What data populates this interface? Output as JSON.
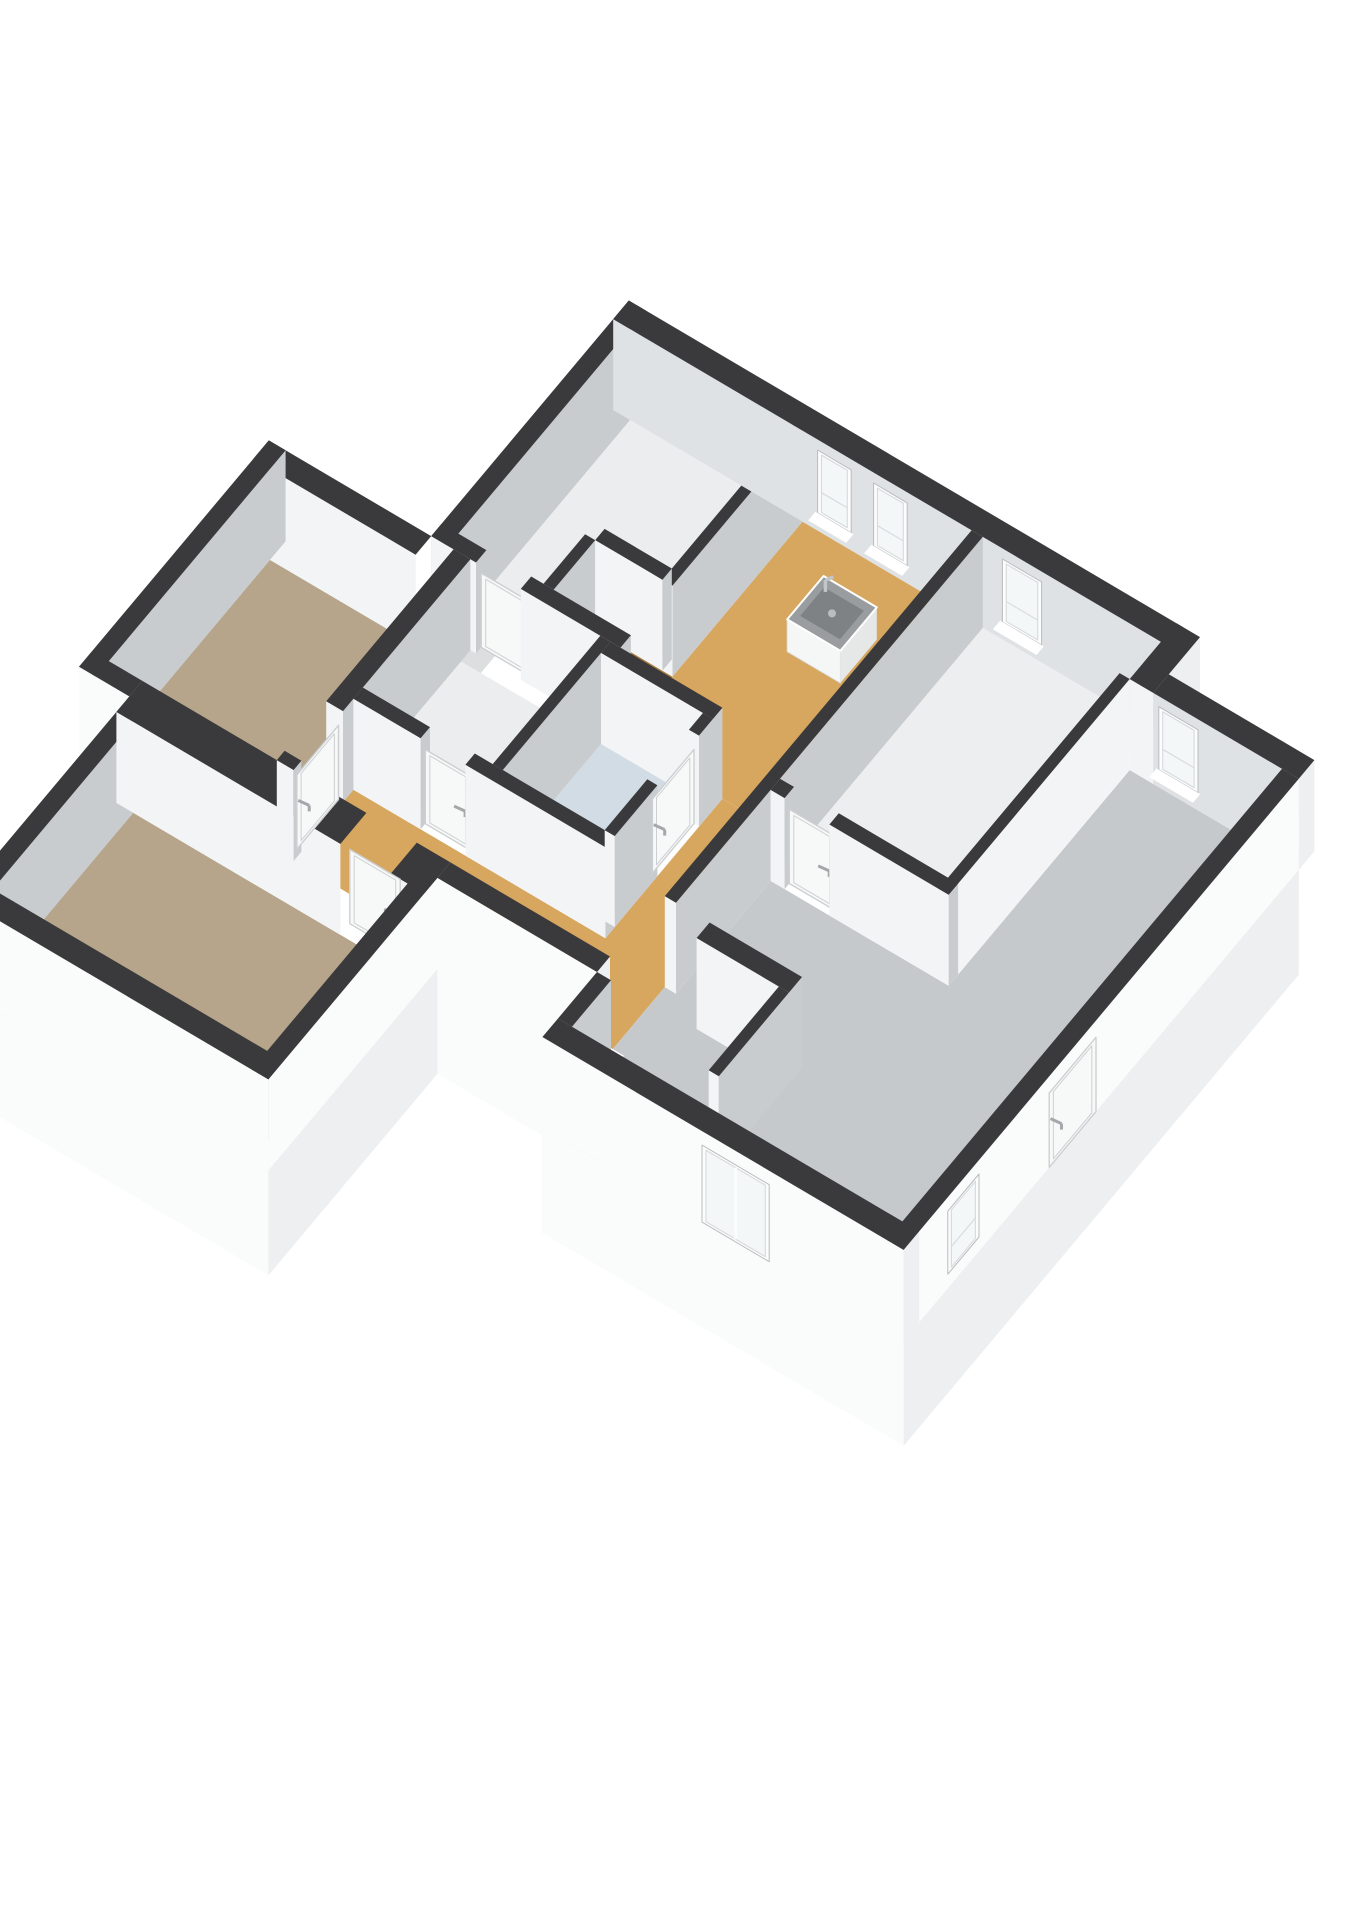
{
  "meta": {
    "background": "#ffffff",
    "view": "isometric-3d-floorplan"
  },
  "palette": {
    "wallTop": "#3a3a3c",
    "intBright": "#f3f4f5",
    "intShade": "#c9ccce",
    "neInt": "#dfe2e4",
    "extWhite": "#fafbfb",
    "extE": "#edeff0",
    "extGray": "#dcdee0",
    "glass": "#f4f7f8",
    "frame": "#fbfcfc",
    "mull": "#d9dcde",
    "reveal": "#b9bcbf",
    "leaf": "#f7f8f8",
    "leafLine": "#cdd0d2",
    "handle": "#a4a8ab",
    "sinkTop": "#999da0",
    "sinkTopDark": "#7e8285",
    "sinkBody": "#f5f6f6",
    "sinkSide": "#e6e8e8",
    "floorStudy": "#ebedee",
    "floorWood": "#a87c3f",
    "floorKitchen": "#d7a75f",
    "floorWhite": "#eceef0",
    "floorBath": "#d2dce4",
    "floorLiving": "#c6c9cb",
    "floorBedroom": "#b6a58b"
  },
  "floorplan": {
    "wall_height": 2.6,
    "skirt_depth": 3.0,
    "rooms": [
      {
        "id": "study",
        "floor": "floorStudy",
        "poly": [
          [
            0,
            0
          ],
          [
            2.9,
            0
          ],
          [
            2.9,
            2.32
          ],
          [
            1.52,
            2.32
          ],
          [
            1.52,
            3.3
          ],
          [
            0,
            3.3
          ]
        ]
      },
      {
        "id": "closet",
        "floor": "floorWood",
        "poly": [
          [
            1.7,
            2.5
          ],
          [
            3.08,
            2.5
          ],
          [
            3.08,
            3.3
          ],
          [
            1.7,
            3.3
          ]
        ]
      },
      {
        "id": "kitchen",
        "floor": "floorKitchen",
        "poly": [
          [
            3.08,
            0
          ],
          [
            6.1,
            0
          ],
          [
            6.1,
            3.5
          ],
          [
            3.08,
            3.5
          ]
        ]
      },
      {
        "id": "bedroom-3",
        "floor": "floorStudy",
        "poly": [
          [
            0.4,
            3.68
          ],
          [
            2.72,
            3.68
          ],
          [
            2.72,
            5.57
          ],
          [
            0.4,
            5.57
          ]
        ]
      },
      {
        "id": "bathroom",
        "floor": "floorBath",
        "poly": [
          [
            2.9,
            3.68
          ],
          [
            4.72,
            3.68
          ],
          [
            4.72,
            5.57
          ],
          [
            2.9,
            5.57
          ]
        ]
      },
      {
        "id": "hall",
        "floor": "floorKitchen",
        "poly": [
          [
            4.9,
            3.5
          ],
          [
            6.1,
            3.5
          ],
          [
            6.1,
            6.9
          ],
          [
            0.4,
            6.9
          ],
          [
            0.4,
            5.75
          ],
          [
            4.9,
            5.75
          ]
        ]
      },
      {
        "id": "bedroom-2",
        "floor": "floorWhite",
        "poly": [
          [
            6.3,
            0
          ],
          [
            9.3,
            0
          ],
          [
            9.3,
            3.9
          ],
          [
            6.3,
            3.9
          ]
        ]
      },
      {
        "id": "living-room",
        "floor": "floorLiving",
        "poly": [
          [
            9.48,
            0.6
          ],
          [
            12.2,
            0.6
          ],
          [
            12.2,
            7.9
          ],
          [
            6.3,
            7.9
          ],
          [
            6.3,
            6.9
          ],
          [
            6.1,
            6.9
          ],
          [
            6.1,
            5.9
          ],
          [
            6.3,
            5.9
          ],
          [
            6.3,
            4.08
          ],
          [
            9.48,
            4.08
          ]
        ]
      },
      {
        "id": "bedroom-west",
        "floor": "floorBedroom",
        "poly": [
          [
            -2.9,
            3.8
          ],
          [
            0.1,
            3.8
          ],
          [
            0.1,
            6.9
          ],
          [
            -2.9,
            6.9
          ]
        ]
      },
      {
        "id": "bedroom-south",
        "floor": "floorBedroom",
        "poly": [
          [
            -2.0,
            7.4
          ],
          [
            2.9,
            7.4
          ],
          [
            2.9,
            10.1
          ],
          [
            -2.0,
            10.1
          ]
        ]
      }
    ],
    "skirt": [
      {
        "id": "skirt-top-west",
        "from": [
          -0.3,
          -0.3
        ],
        "to": [
          -0.3,
          3.5
        ],
        "color": "extGray"
      },
      {
        "id": "skirt-wing-west",
        "from": [
          -3.2,
          3.5
        ],
        "to": [
          -3.2,
          7.15
        ],
        "color": "extGray"
      },
      {
        "id": "skirt-wing-south",
        "from": [
          -3.2,
          7.15
        ],
        "to": [
          -2.3,
          7.15
        ],
        "color": "extWhite"
      },
      {
        "id": "skirt-swbed-west",
        "from": [
          -2.3,
          7.15
        ],
        "to": [
          -2.3,
          10.4
        ],
        "color": "extGray"
      },
      {
        "id": "skirt-swbed-south",
        "from": [
          -2.3,
          10.4
        ],
        "to": [
          3.2,
          10.4
        ],
        "color": "extWhite"
      },
      {
        "id": "skirt-swbed-east",
        "from": [
          3.2,
          7.15
        ],
        "to": [
          3.2,
          10.4
        ],
        "color": "extE"
      },
      {
        "id": "skirt-hall-south",
        "from": [
          3.2,
          7.15
        ],
        "to": [
          6.05,
          7.15
        ],
        "color": "extWhite"
      },
      {
        "id": "skirt-living-west",
        "from": [
          6.05,
          7.15
        ],
        "to": [
          6.05,
          8.2
        ],
        "color": "extGray"
      },
      {
        "id": "skirt-living-south",
        "from": [
          6.05,
          8.2
        ],
        "to": [
          12.5,
          8.2
        ],
        "color": "extWhite"
      },
      {
        "id": "skirt-living-east",
        "from": [
          12.5,
          0.6
        ],
        "to": [
          12.5,
          8.2
        ],
        "color": "extE"
      }
    ],
    "walls": [
      {
        "id": "ext-ne-top",
        "rect": [
          -0.3,
          -0.3,
          9.6,
          0
        ],
        "faces": {
          "S": "neInt",
          "E": "extE"
        }
      },
      {
        "id": "ext-ne-jog",
        "rect": [
          9.48,
          -0.3,
          9.9,
          0.6
        ],
        "faces": {
          "S": "intBright",
          "E": "extE"
        }
      },
      {
        "id": "ext-ne-living",
        "rect": [
          9.9,
          0.3,
          12.5,
          0.6
        ],
        "faces": {
          "S": "neInt",
          "E": "extE"
        }
      },
      {
        "id": "ext-east",
        "rect": [
          12.2,
          0.6,
          12.5,
          8.2
        ],
        "faces": {
          "E": "extWhite"
        }
      },
      {
        "id": "ext-south",
        "rect": [
          6.05,
          7.9,
          12.5,
          8.2
        ],
        "faces": {
          "S": "extWhite",
          "E": "extE"
        }
      },
      {
        "id": "ext-living-w",
        "rect": [
          6.05,
          7.15,
          6.3,
          7.9
        ],
        "faces": {
          "E": "intShade",
          "W": "extGray"
        }
      },
      {
        "id": "ext-hall-s",
        "rect": [
          3.2,
          6.9,
          6.05,
          7.15
        ],
        "faces": {
          "S": "extWhite",
          "E": "extE"
        }
      },
      {
        "id": "ext-west-top",
        "rect": [
          -0.3,
          -0.3,
          0,
          3.5
        ],
        "faces": {
          "E": "intShade",
          "W": "extGray"
        }
      },
      {
        "id": "ext-wing-n",
        "rect": [
          -3.2,
          3.5,
          -0.3,
          3.8
        ],
        "faces": {
          "S": "intBright",
          "W": "extGray"
        }
      },
      {
        "id": "ext-wing-w",
        "rect": [
          -3.2,
          3.5,
          -2.9,
          7.15
        ],
        "faces": {
          "E": "intShade",
          "W": "extGray"
        }
      },
      {
        "id": "ext-wing-s",
        "rect": [
          -3.2,
          6.9,
          -2.3,
          7.15
        ],
        "faces": {
          "S": "extWhite",
          "W": "extGray"
        }
      },
      {
        "id": "ext-swbed-w",
        "rect": [
          -2.3,
          7.15,
          -2.0,
          10.4
        ],
        "faces": {
          "E": "intShade",
          "W": "extGray"
        }
      },
      {
        "id": "ext-swbed-s",
        "rect": [
          -2.3,
          10.1,
          3.2,
          10.4
        ],
        "faces": {
          "S": "extWhite",
          "E": "extE"
        }
      },
      {
        "id": "ext-swbed-e",
        "rect": [
          2.9,
          7.15,
          3.2,
          10.4
        ],
        "faces": {
          "E": "extWhite"
        }
      },
      {
        "id": "wall-swbed-n1",
        "rect": [
          -2.3,
          6.9,
          1.7,
          7.4
        ],
        "faces": {
          "S": "intBright"
        }
      },
      {
        "id": "wall-swbed-n2",
        "rect": [
          2.6,
          6.9,
          3.2,
          7.4
        ],
        "faces": {
          "S": "intBright",
          "E": "extWhite"
        }
      },
      {
        "id": "wall-study-kitchen",
        "rect": [
          2.9,
          0,
          3.08,
          2.5
        ],
        "faces": {
          "S": "intBright",
          "E": "intShade"
        }
      },
      {
        "id": "wall-closet-n",
        "rect": [
          1.7,
          2.32,
          2.9,
          2.5
        ],
        "faces": {
          "S": "intBright",
          "E": "intShade"
        }
      },
      {
        "id": "wall-closet-w",
        "rect": [
          1.52,
          2.5,
          1.7,
          3.3
        ],
        "faces": {
          "S": "intBright",
          "E": "intShade"
        }
      },
      {
        "id": "wall-study-b3-a",
        "rect": [
          -0.3,
          3.3,
          0.5,
          3.5
        ],
        "faces": {
          "S": "intBright",
          "E": "intShade"
        }
      },
      {
        "id": "wall-study-b3-b",
        "rect": [
          1.3,
          3.3,
          3.08,
          3.5
        ],
        "faces": {
          "S": "intBright",
          "E": "intShade"
        }
      },
      {
        "id": "wall-kitchen-bath",
        "rect": [
          2.9,
          3.5,
          4.9,
          3.68
        ],
        "faces": {
          "S": "intBright",
          "E": "intShade"
        }
      },
      {
        "id": "wall-b3-bath",
        "rect": [
          2.72,
          3.5,
          2.9,
          5.57
        ],
        "faces": {
          "S": "intBright",
          "E": "intShade"
        }
      },
      {
        "id": "wall-bath-e1",
        "rect": [
          4.72,
          3.68,
          4.9,
          3.95
        ],
        "faces": {
          "S": "intBright",
          "E": "intShade"
        }
      },
      {
        "id": "wall-bath-e2",
        "rect": [
          4.72,
          4.75,
          4.9,
          5.57
        ],
        "faces": {
          "S": "intBright",
          "E": "intShade"
        }
      },
      {
        "id": "wall-b3-hall-a",
        "rect": [
          0.4,
          5.57,
          1.6,
          5.75
        ],
        "faces": {
          "S": "intBright",
          "E": "intShade"
        }
      },
      {
        "id": "wall-b3-hall-b",
        "rect": [
          2.4,
          5.57,
          4.9,
          5.75
        ],
        "faces": {
          "S": "intBright",
          "E": "intShade"
        }
      },
      {
        "id": "wall-hall-e",
        "rect": [
          6.1,
          0,
          6.3,
          5.9
        ],
        "faces": {
          "S": "intBright",
          "E": "intShade"
        }
      },
      {
        "id": "wall-bed2-s-a",
        "rect": [
          6.3,
          3.9,
          6.55,
          4.08
        ],
        "faces": {
          "S": "intBright",
          "E": "intShade"
        }
      },
      {
        "id": "wall-bed2-s-b",
        "rect": [
          7.35,
          3.9,
          9.48,
          4.08
        ],
        "faces": {
          "S": "intBright",
          "E": "intShade"
        }
      },
      {
        "id": "wall-bed2-living",
        "rect": [
          9.3,
          0.6,
          9.48,
          4.08
        ],
        "faces": {
          "S": "intBright",
          "E": "intBright"
        }
      },
      {
        "id": "wall-partition-a",
        "rect": [
          6.9,
          5.9,
          8.55,
          6.15
        ],
        "faces": {
          "S": "intBright",
          "E": "intShade"
        }
      },
      {
        "id": "wall-partition-b",
        "rect": [
          8.37,
          6.15,
          8.55,
          7.5
        ],
        "faces": {
          "S": "intBright",
          "E": "intShade"
        }
      },
      {
        "id": "wall-wing-e1",
        "rect": [
          0.1,
          3.5,
          0.4,
          5.95
        ],
        "faces": {
          "S": "intBright",
          "E": "intShade"
        }
      },
      {
        "id": "wall-wing-e2",
        "rect": [
          0.1,
          6.75,
          0.4,
          6.9
        ],
        "faces": {
          "S": "intBright",
          "E": "intShade"
        }
      }
    ],
    "doors": [
      {
        "id": "door-study",
        "axis": "s",
        "at": 3.4,
        "range": [
          0.5,
          1.3
        ],
        "handle": false
      },
      {
        "id": "door-bedroom-3",
        "axis": "s",
        "at": 5.66,
        "range": [
          1.6,
          2.4
        ],
        "handle": true
      },
      {
        "id": "door-bathroom",
        "axis": "e",
        "at": 4.81,
        "range": [
          3.95,
          4.75
        ],
        "handle": true
      },
      {
        "id": "door-bedroom-west",
        "axis": "e",
        "at": 0.32,
        "range": [
          5.95,
          6.75
        ],
        "handle": true
      },
      {
        "id": "door-bedroom-south",
        "axis": "s",
        "at": 7.22,
        "range": [
          1.7,
          2.6
        ],
        "handle": true
      },
      {
        "id": "door-bedroom-2",
        "axis": "s",
        "at": 3.99,
        "range": [
          6.55,
          7.35
        ],
        "handle": true
      },
      {
        "id": "door-exterior-east",
        "axis": "e",
        "at": 12.5,
        "range": [
          4.5,
          5.4
        ],
        "handle": true
      }
    ],
    "windows": [
      {
        "id": "window-kitchen-1",
        "axis": "s",
        "at": 0,
        "range": [
          3.35,
          3.95
        ],
        "z": [
          0.5,
          2.3
        ],
        "sill": true
      },
      {
        "id": "window-kitchen-2",
        "axis": "s",
        "at": 0,
        "range": [
          4.35,
          4.95
        ],
        "z": [
          0.5,
          2.3
        ],
        "sill": true
      },
      {
        "id": "window-bedroom-2",
        "axis": "s",
        "at": 0,
        "range": [
          6.65,
          7.35
        ],
        "z": [
          0.5,
          2.3
        ],
        "sill": true
      },
      {
        "id": "window-living-ne",
        "axis": "s",
        "at": 0.6,
        "range": [
          10.0,
          10.7
        ],
        "z": [
          0.5,
          2.3
        ],
        "sill": true
      },
      {
        "id": "window-living-e",
        "axis": "e",
        "at": 12.5,
        "range": [
          6.75,
          7.35
        ],
        "z": [
          0.4,
          2.2
        ],
        "sill": false
      },
      {
        "id": "glassdoor-living-s",
        "axis": "s",
        "at": 8.2,
        "range": [
          8.9,
          10.1
        ],
        "z": [
          0,
          2.2
        ],
        "sill": false,
        "mullion": true
      }
    ],
    "fixtures": [
      {
        "id": "kitchen-sink-unit",
        "rect": [
          4.2,
          0.8,
          5.15,
          1.5
        ],
        "h": 0.92
      }
    ]
  }
}
